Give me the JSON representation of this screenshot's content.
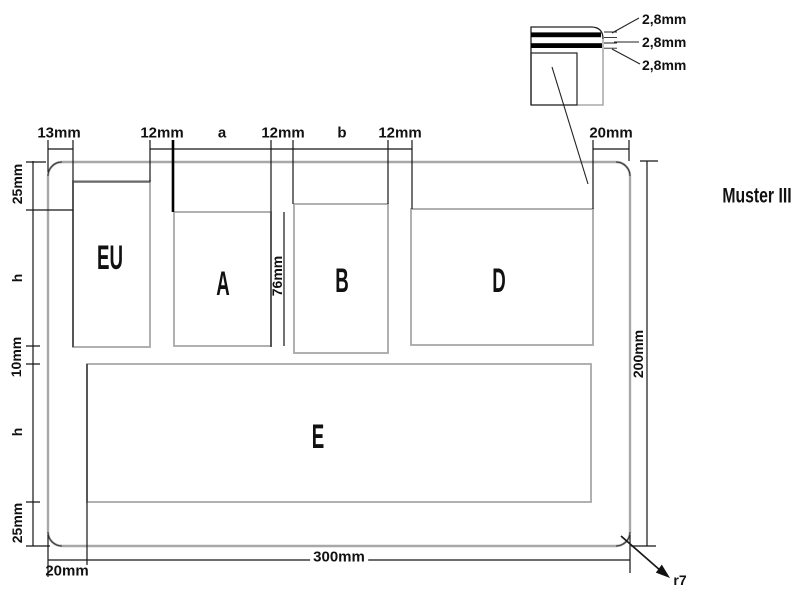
{
  "title": "Muster III",
  "regions": {
    "eu": "EU",
    "a": "A",
    "b": "B",
    "d": "D",
    "e": "E"
  },
  "dimensions": {
    "top": {
      "left_margin": "13mm",
      "gap1": "12mm",
      "col_a": "a",
      "gap2": "12mm",
      "col_b": "b",
      "gap3": "12mm",
      "right_margin": "20mm"
    },
    "left": {
      "top_margin": "25mm",
      "row1_height": "h",
      "row_gap": "10mm",
      "row2_height": "h",
      "bottom_margin": "25mm"
    },
    "width_76": "76mm",
    "height_200": "200mm",
    "width_300": "300mm",
    "bottom_left": "20mm",
    "corner_radius": "r7"
  },
  "detail": {
    "layers": [
      "2,8mm",
      "2,8mm",
      "2,8mm"
    ]
  }
}
